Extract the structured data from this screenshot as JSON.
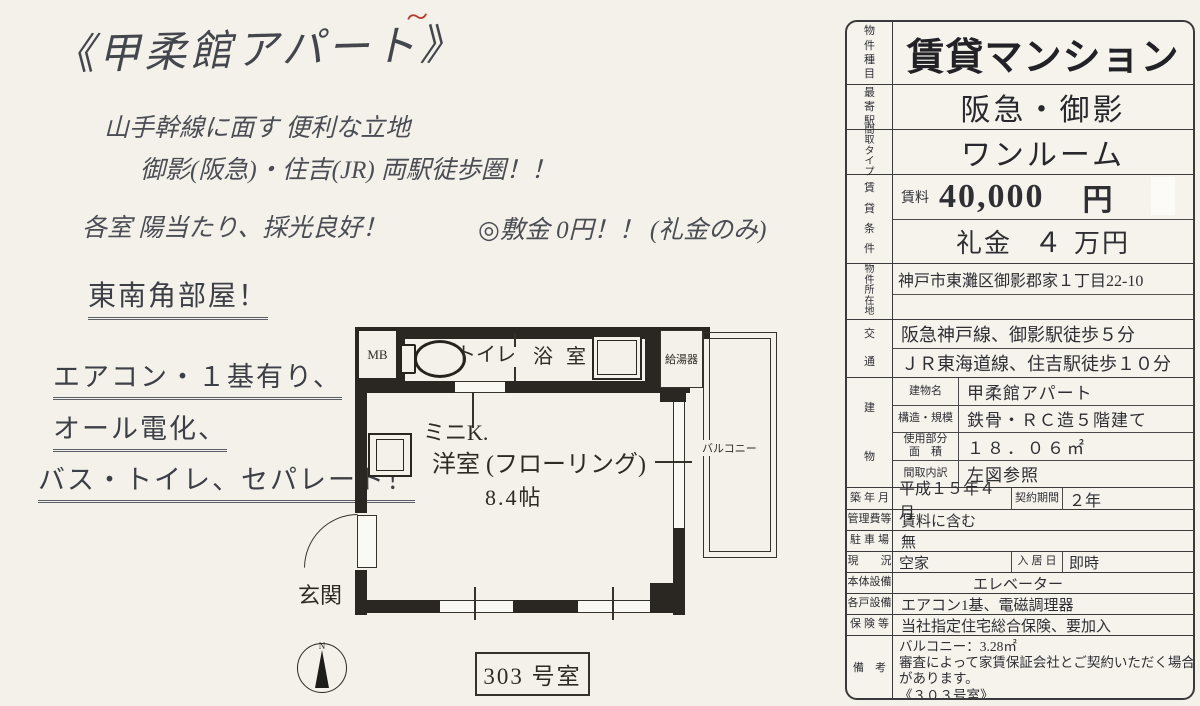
{
  "flyer": {
    "title": "《甲柔館アパート》",
    "red_mark": "〜",
    "catch1": "山手幹線に面す 便利な立地",
    "catch2": "御影(阪急)・住吉(JR)  両駅徒歩圏！！",
    "catch3": "各室 陽当たり、採光良好！",
    "deposit_note": "◎敷金 0円！！ (礼金のみ)",
    "features": [
      "東南角部屋！",
      "エアコン・１基有り、",
      "オール電化、",
      "バス・トイレ、セパレート！"
    ]
  },
  "floorplan": {
    "mb": "MB",
    "toilet": "トイレ",
    "bath": "浴 室",
    "water_heater": "給湯器",
    "mini_kitchen": "ミニK.",
    "main_room": "洋室 (フローリング)",
    "room_size": "8.4帖",
    "balcony": "バルコニー",
    "entrance": "玄関",
    "room_number": "303 号室",
    "compass_n": "N"
  },
  "table": {
    "property_type_label": "物件種目",
    "property_type": "賃貸マンション",
    "nearest_station_label": "最寄駅",
    "nearest_station": "阪急・御影",
    "layout_type_label": "間取タイプ",
    "layout_type": "ワンルーム",
    "terms_label": "賃貸条件",
    "rent_label": "賃料",
    "rent_value": "40,000",
    "rent_unit": "円",
    "key_money_label": "礼金",
    "key_money_amount": "４",
    "key_money_unit": "万円",
    "address_label": "物件所在地",
    "address": "神戸市東灘区御影郡家１丁目22-10",
    "access_label": "交通",
    "access_line1": "阪急神戸線、御影駅徒歩５分",
    "access_line2": "ＪＲ東海道線、住吉駅徒歩１０分",
    "building_label": "建物",
    "building_name_label": "建物名",
    "building_name": "甲柔館アパート",
    "structure_label": "構造・規模",
    "structure": "鉄骨・ＲＣ造５階建て",
    "area_label": "使用部分\n面　積",
    "area": "１８．０６㎡",
    "layout_detail_label": "間取内訳",
    "layout_detail": "左図参照",
    "built_label": "築 年 月",
    "built": "平成１５年４月",
    "contract_label": "契約期間",
    "contract": "２年",
    "mgmt_fee_label": "管理費等",
    "mgmt_fee": "賃料に含む",
    "parking_label": "駐 車 場",
    "parking": "無",
    "status_label": "現　　況",
    "status": "空家",
    "movein_label": "入 居 日",
    "movein": "即時",
    "bldg_equip_label": "本体設備",
    "bldg_equip": "エレベーター",
    "unit_equip_label": "各戸設備",
    "unit_equip": "エアコン1基、電磁調理器",
    "insurance_label": "保 険 等",
    "insurance": "当社指定住宅総合保険、要加入",
    "remarks_label": "備　考",
    "remarks": [
      "バルコニー：3.28㎡",
      "審査によって家賃保証会社とご契約いただく場合",
      "があります。",
      "《３０３号室》"
    ]
  }
}
